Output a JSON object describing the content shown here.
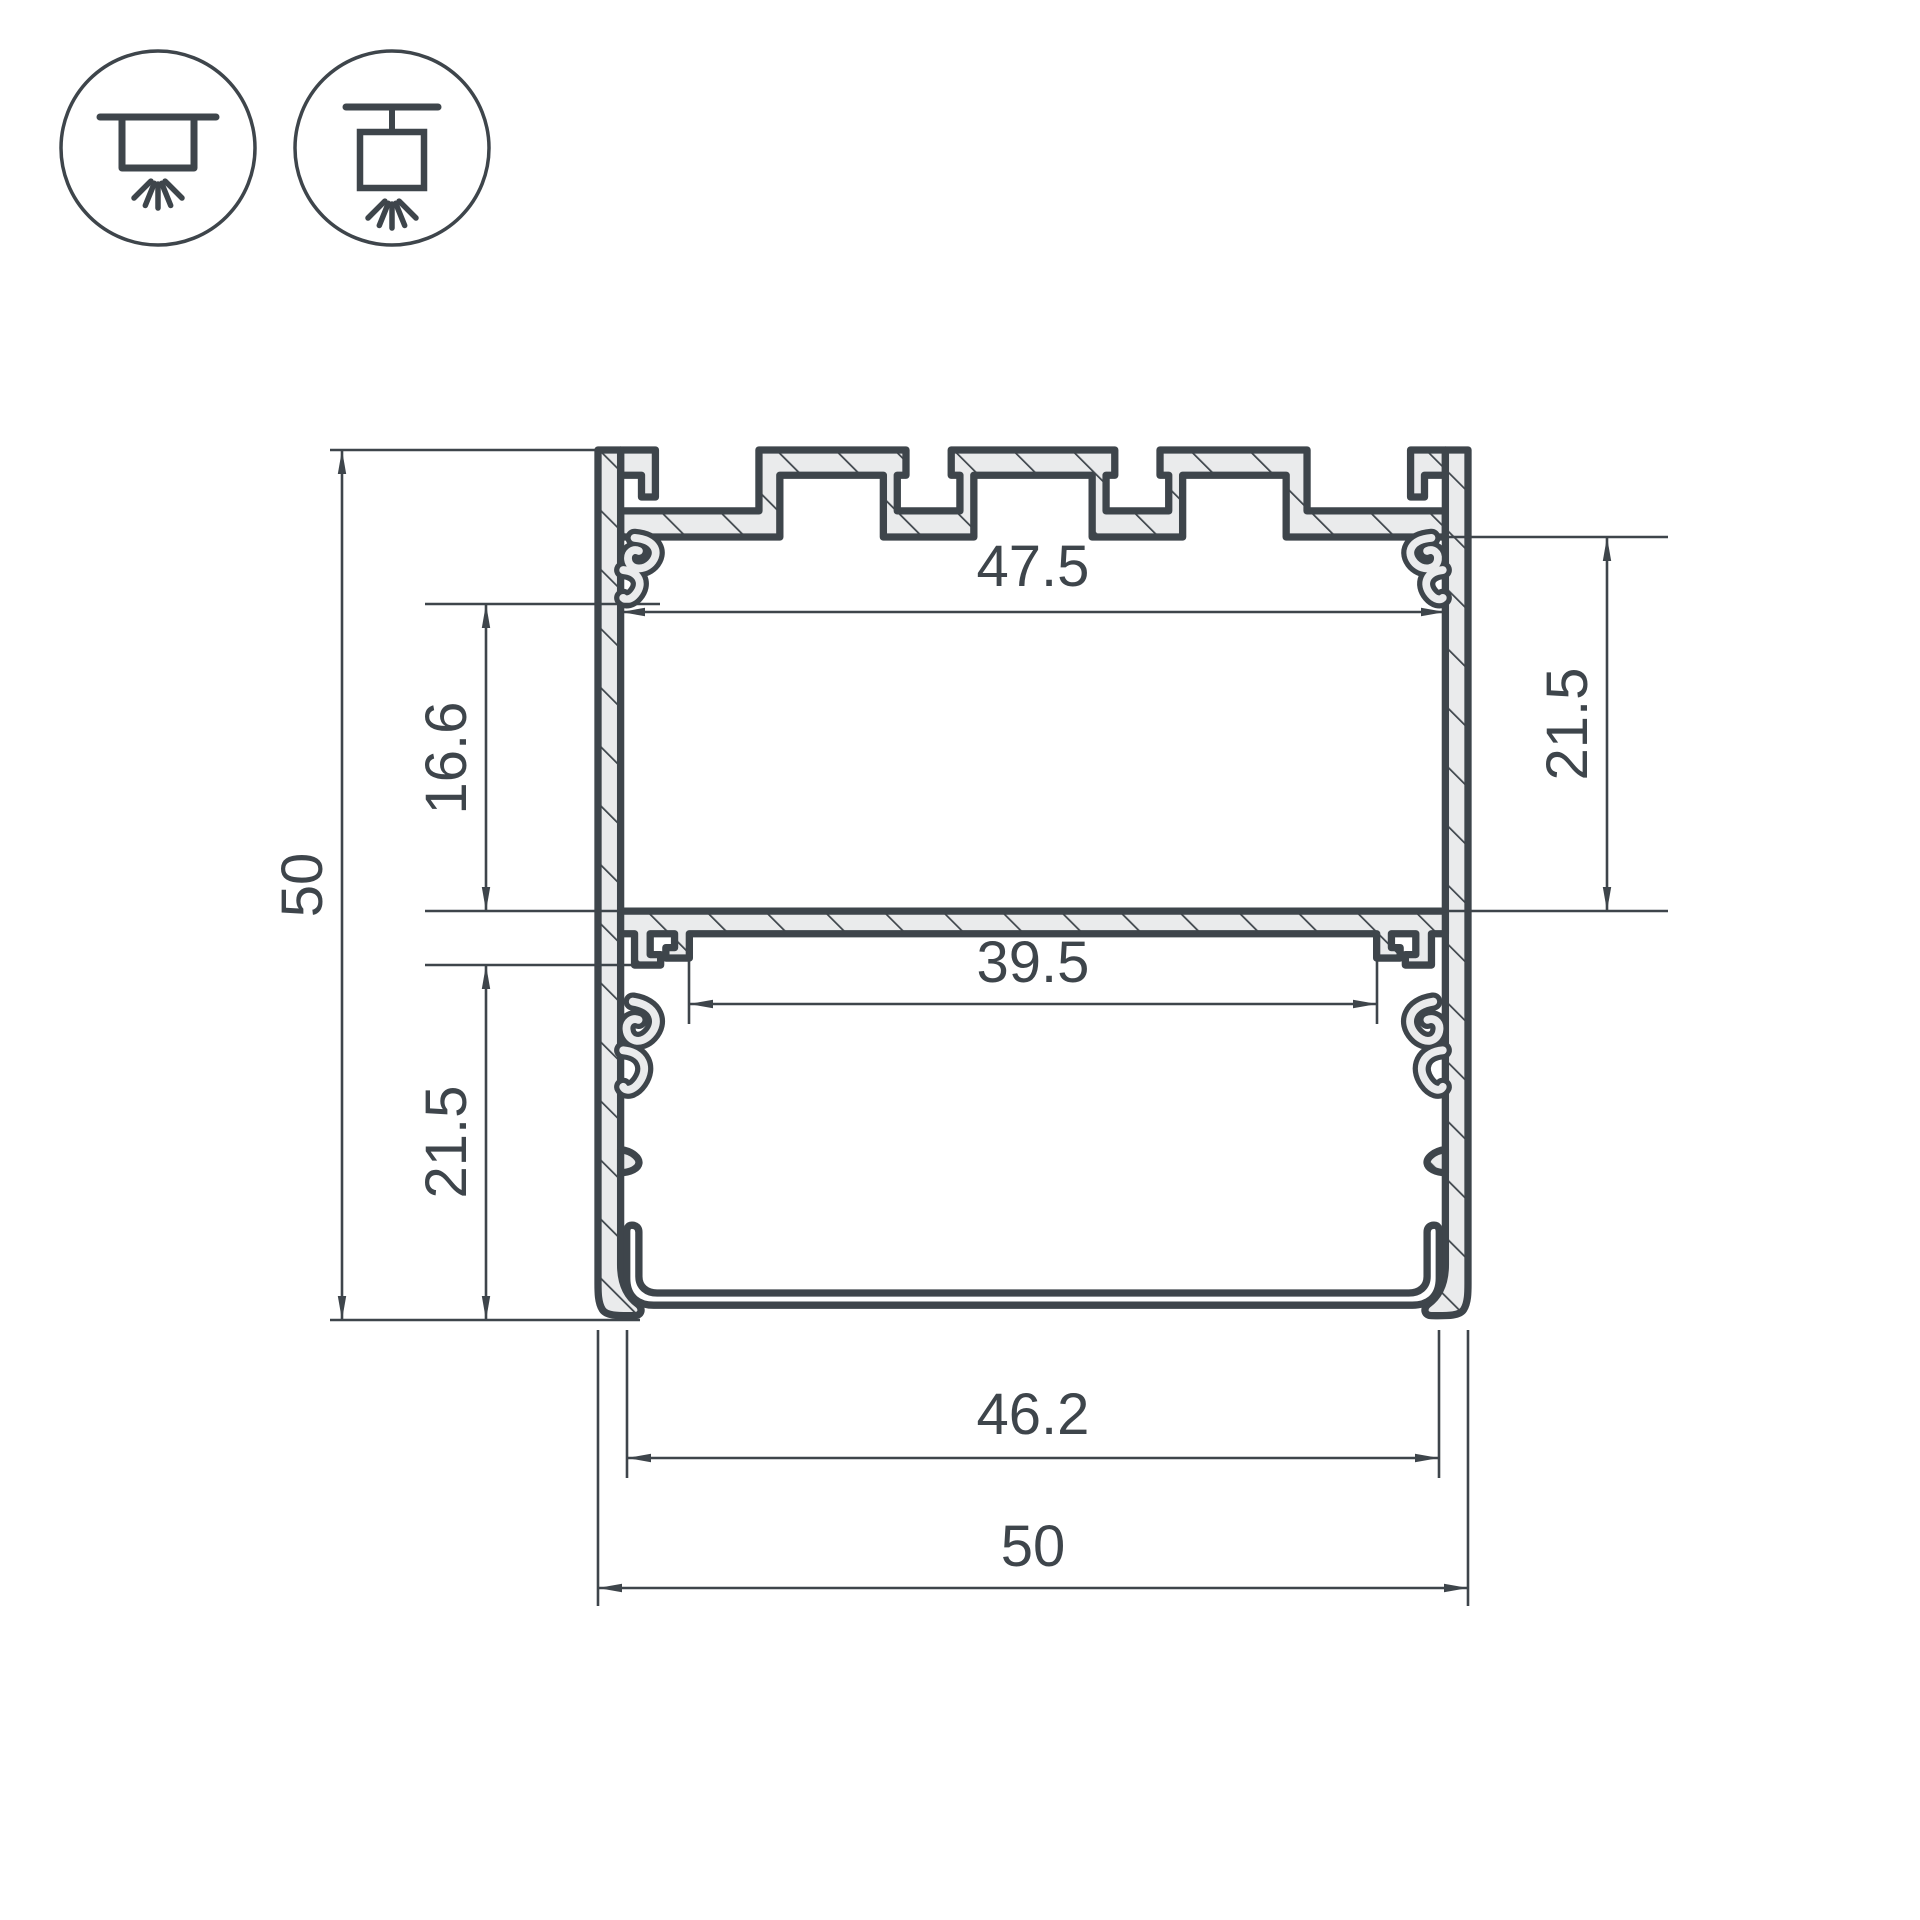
{
  "drawing": {
    "title": "LED profile cross-section technical drawing",
    "colors": {
      "line": "#3e454b",
      "metal_fill": "#eaebec",
      "diffuser_fill": "#ffffff",
      "background": "#ffffff"
    },
    "icons": [
      {
        "name": "surface-mount-light-icon"
      },
      {
        "name": "pendant-mount-light-icon"
      }
    ],
    "dims": {
      "height_overall": "50",
      "height_upper_inner": "16.6",
      "height_lower_inner": "21.5",
      "width_inner_top": "47.5",
      "height_right_inner": "21.5",
      "width_shelf_slot": "39.5",
      "width_diffuser": "46.2",
      "width_overall": "50"
    }
  }
}
